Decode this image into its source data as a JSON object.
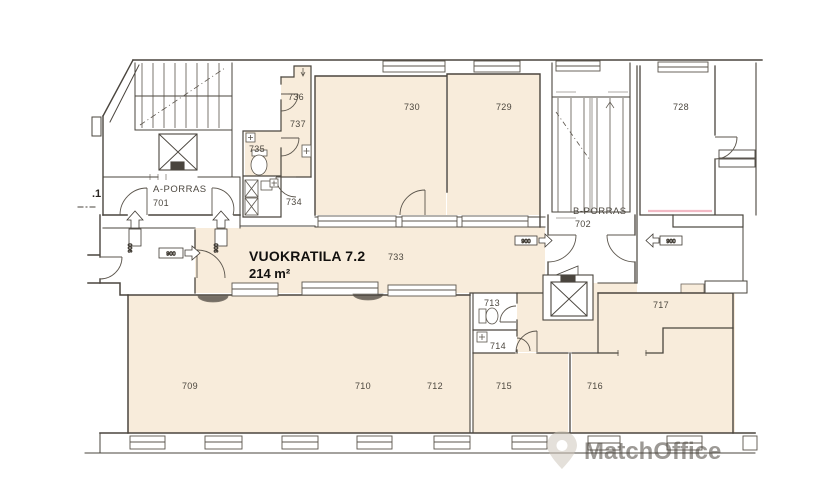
{
  "floorplan": {
    "rental_label": {
      "title": "VUOKRATILA 7.2",
      "area": "214 m²"
    },
    "stairwells": {
      "a": {
        "name": "A-PORRAS",
        "number": "701"
      },
      "b": {
        "name": "B-PORRAS",
        "number": "702"
      }
    },
    "partial_room_label": ".1",
    "rooms": {
      "r709": "709",
      "r710": "710",
      "r712": "712",
      "r713": "713",
      "r714": "714",
      "r715": "715",
      "r716": "716",
      "r717": "717",
      "r728": "728",
      "r729": "729",
      "r730": "730",
      "r733": "733",
      "r734": "734",
      "r735": "735",
      "r736": "736",
      "r737": "737"
    },
    "door_width": "900",
    "watermark": "MatchOffice",
    "colors": {
      "rental_fill": "#f8ecdb",
      "wall": "#4a453e",
      "background": "#ffffff",
      "accent_pink": "#f2b9c4",
      "watermark": "#cfc8bc"
    }
  }
}
